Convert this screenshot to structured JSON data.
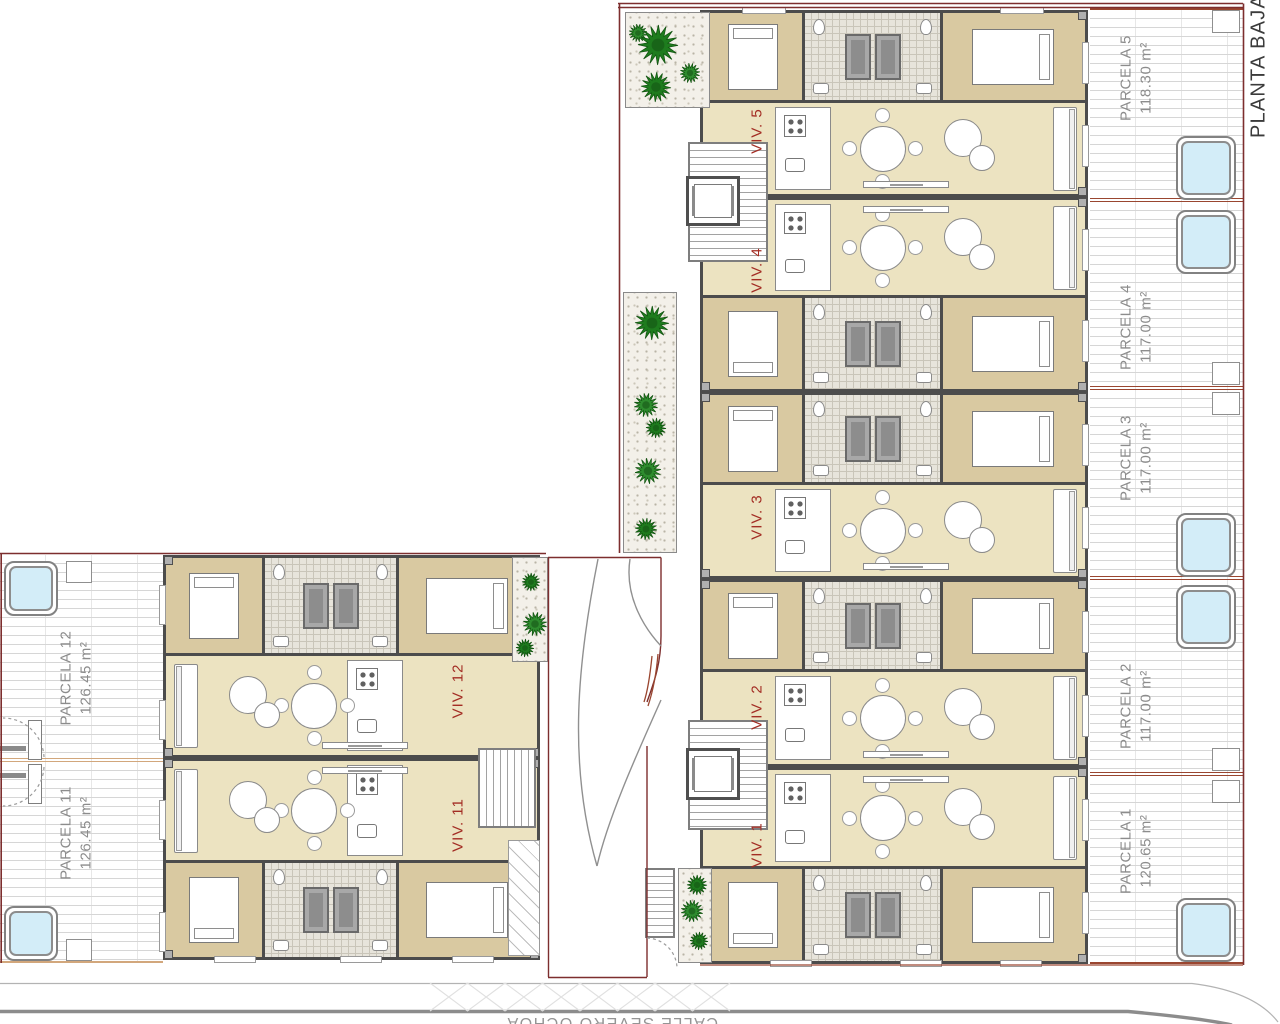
{
  "header": {
    "plan_label": "PLANTA BAJA"
  },
  "street": {
    "name": "CALLE SEVERO OCHOA"
  },
  "parcels_right": [
    {
      "name": "PARCELA 5",
      "area": "118.30 m²"
    },
    {
      "name": "PARCELA 4",
      "area": "117.00 m²"
    },
    {
      "name": "PARCELA 3",
      "area": "117.00 m²"
    },
    {
      "name": "PARCELA 2",
      "area": "117.00 m²"
    },
    {
      "name": "PARCELA 1",
      "area": "120.65 m²"
    }
  ],
  "parcels_left": [
    {
      "name": "PARCELA 12",
      "area": "126.45 m²"
    },
    {
      "name": "PARCELA 11",
      "area": "126.45 m²"
    }
  ],
  "dwellings_right": [
    {
      "label": "VIV. 5"
    },
    {
      "label": "VIV. 4"
    },
    {
      "label": "VIV. 3"
    },
    {
      "label": "VIV. 2"
    },
    {
      "label": "VIV. 1"
    }
  ],
  "dwellings_left": [
    {
      "label": "VIV. 12"
    },
    {
      "label": "VIV. 11"
    }
  ],
  "palette": {
    "boundary_red": "#7d2e2e",
    "divider_brown": "#9a4630",
    "divider_tan": "#d2a77c",
    "wall_dark": "#4c4c4c",
    "room_tan": "#d9c9a1",
    "room_cream": "#ece3c1",
    "bath_tile": "#e7e4db",
    "pool_fill": "#d3edf8",
    "tree_green": "#1e7c1e",
    "gravel": "#f3f0e9",
    "hatch_gray": "#d6d6d6",
    "label_gray": "#8c8c8c",
    "viv_red": "#a32d24",
    "street_gray": "#949494"
  }
}
